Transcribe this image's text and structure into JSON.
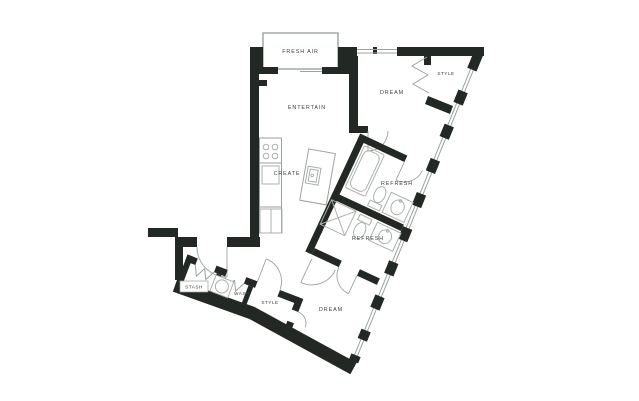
{
  "colors": {
    "wall": "#222823",
    "line": "#9aa39d",
    "fixture": "#aab1ac",
    "text": "#3a403b"
  },
  "rooms": {
    "balcony": "FRESH AIR",
    "living": "ENTERTAIN",
    "bedroom_top": "DREAM",
    "closet_top": "STYLE",
    "kitchen": "CREATE",
    "bath_top": "REFRESH",
    "bath_bottom": "REFRESH",
    "storage": "STASH",
    "laundry": "WASH",
    "closet_bottom": "STYLE",
    "bedroom_bottom": "DREAM"
  }
}
